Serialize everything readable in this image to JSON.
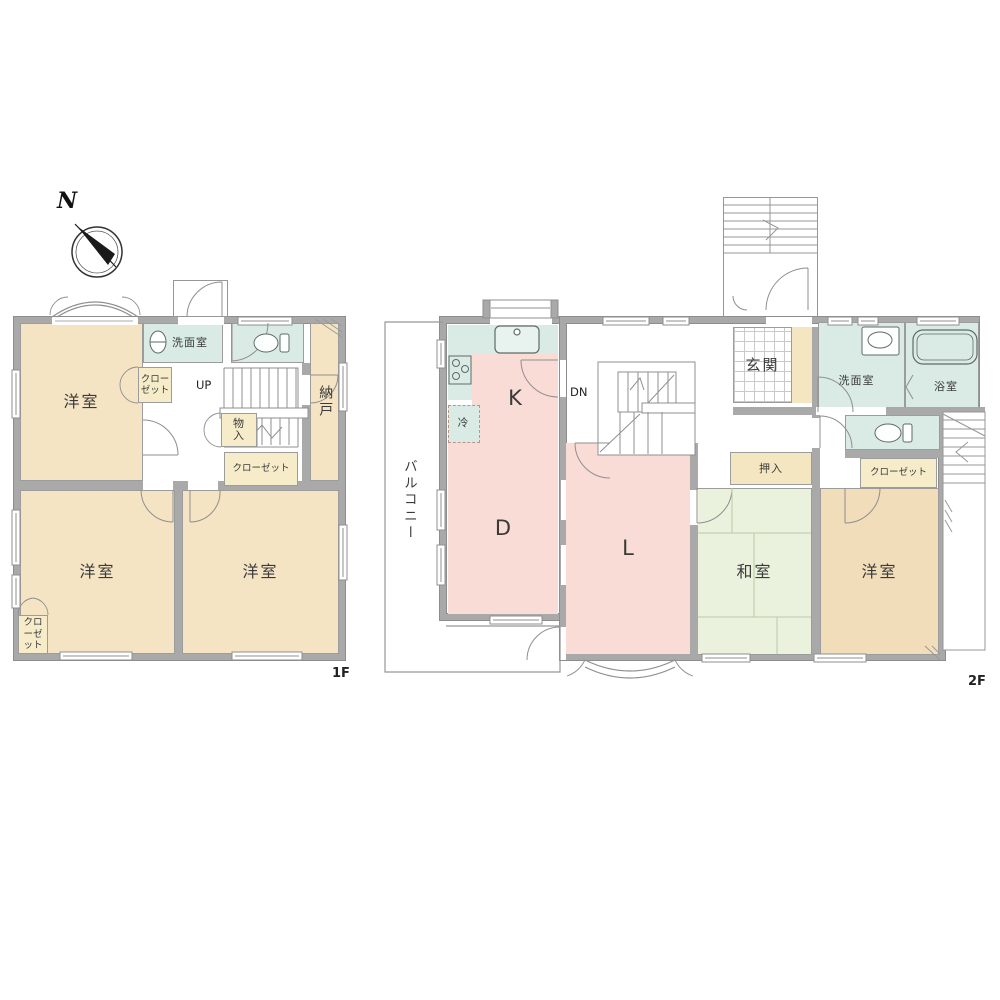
{
  "compass": {
    "north_label": "N"
  },
  "colors": {
    "wall": "#a9a9a9",
    "room_tan": "#f4e4c4",
    "room_tan_dark": "#f1ddba",
    "closet_yellow": "#f6ecca",
    "water_teal": "#d9ebe4",
    "ldk_pink": "#f9dcd5",
    "tatami_green": "#eaf2dd",
    "entry_tan": "#f3e6c0"
  },
  "floor1": {
    "floor_label": "1F",
    "rooms": {
      "bedroom_nw": "洋室",
      "bedroom_sw": "洋室",
      "bedroom_se": "洋室",
      "washroom": "洗面室",
      "storage_room": "納戸",
      "storage_small": "物入",
      "closet_nw": "クローゼット",
      "closet_mid": "クローゼット",
      "closet_sw": "クローゼット",
      "stairs_up": "UP"
    }
  },
  "floor2": {
    "floor_label": "2F",
    "rooms": {
      "kitchen": "K",
      "dining": "D",
      "living": "L",
      "japanese_room": "和室",
      "bedroom": "洋室",
      "entrance": "玄関",
      "hall": "ホール",
      "washroom": "洗面室",
      "bathroom": "浴室",
      "oshiire": "押入",
      "closet": "クローゼット",
      "fridge": "冷",
      "stairs_down": "DN",
      "balcony": "バルコニー"
    }
  }
}
